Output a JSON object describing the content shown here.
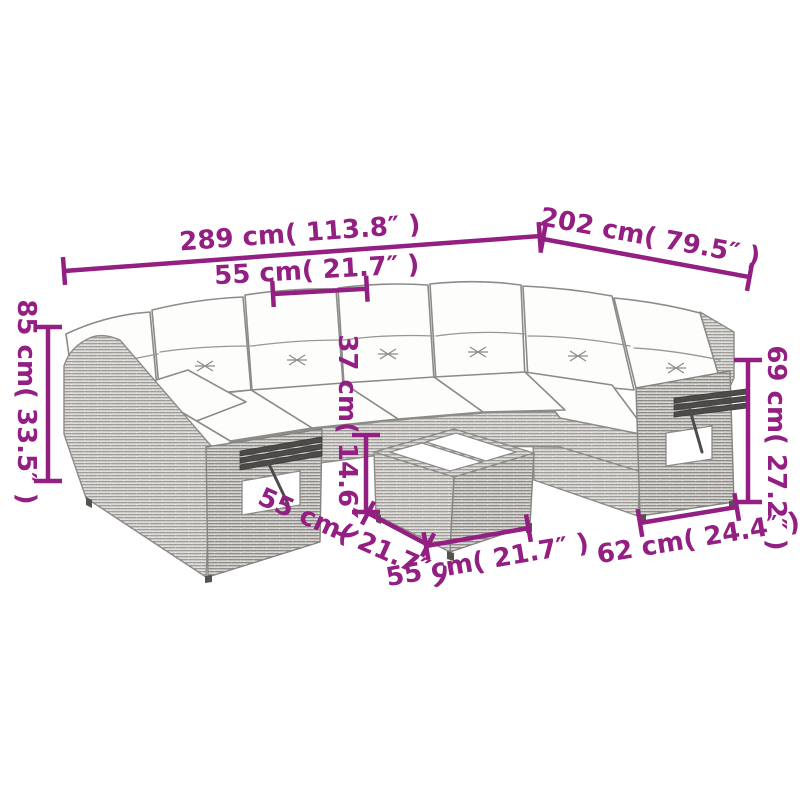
{
  "diagram": {
    "type": "product-dimension-drawing",
    "subject": "rattan corner sofa set with cushions and coffee table",
    "background_color": "#ffffff",
    "accent_color": "#921f81",
    "sketch_color": "#8c8c89"
  },
  "dimensions": [
    {
      "id": "overall-width",
      "label": "289 cm( 113.8″ )"
    },
    {
      "id": "overall-depth",
      "label": "202 cm( 79.5″ )"
    },
    {
      "id": "seat-width",
      "label": "55 cm( 21.7″ )"
    },
    {
      "id": "total-height",
      "label": "85 cm( 33.5″ )"
    },
    {
      "id": "table-height",
      "label": "37 cm( 14.6″ )"
    },
    {
      "id": "arm-height",
      "label": "69 cm( 27.2″ )"
    },
    {
      "id": "seat-depth",
      "label": "55 cm( 21.7″ )"
    },
    {
      "id": "table-width",
      "label": "55 cm( 21.7″ )"
    },
    {
      "id": "end-section-width",
      "label": "62 cm( 24.4″ )"
    }
  ]
}
